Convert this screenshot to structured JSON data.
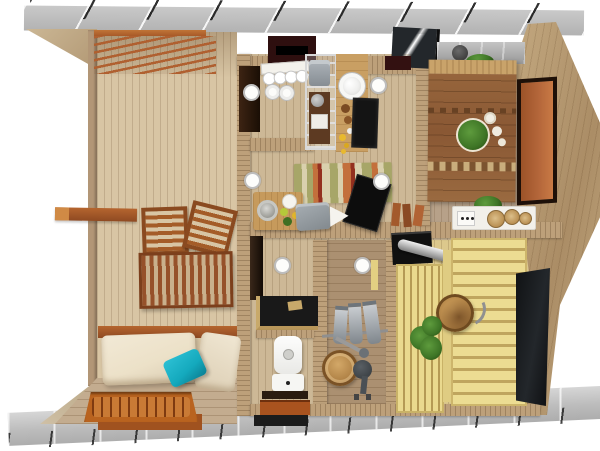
{
  "scene": {
    "description": "3D top-down rendering of a small wooden sauna house floor plan with an open deck, kitchen, bedroom, living strip, bathroom, washroom and sauna, bordered by concrete footing strips",
    "view": "top-down cutaway, no text labels",
    "rooms": [
      {
        "name": "deck-terrace",
        "features": [
          "pergola-slats",
          "lounge-chairs",
          "slatted-table",
          "daybed",
          "teal-pillow",
          "drain-grate",
          "protruding-beam"
        ]
      },
      {
        "name": "kitchen",
        "features": [
          "dish-shelf",
          "metal-rack",
          "sink-counter",
          "induction-cooktop",
          "window",
          "skylight"
        ]
      },
      {
        "name": "bedroom",
        "features": [
          "double-bed",
          "potted-plant",
          "stone-ledge",
          "orange-door"
        ]
      },
      {
        "name": "living-area",
        "features": [
          "striped-rug",
          "tv-panel",
          "food-tray",
          "gray-cushion",
          "ceiling-lights"
        ]
      },
      {
        "name": "bathroom",
        "features": [
          "toilet",
          "shower-counter",
          "floor-mats"
        ]
      },
      {
        "name": "washroom",
        "features": [
          "towel-rail",
          "wooden-barrel",
          "water-pump"
        ]
      },
      {
        "name": "sauna",
        "features": [
          "sauna-stove",
          "chimney-pipe",
          "tiered-benches",
          "wooden-bucket",
          "birch-whisk",
          "glass-door"
        ]
      }
    ],
    "ceiling_light_count": 6
  },
  "palette": {
    "background": "#ffffff",
    "concrete": "#c2c2c2",
    "concrete_dark": "#a9a9a9",
    "deck_floor": "#d8c5a4",
    "interior_floor": "#cdb896",
    "bedroom_floor": "#b7a189",
    "washroom_floor": "#ab9071",
    "sauna_floor": "#dcc88c",
    "wall": "#bda07a",
    "wall_dark": "#a88a64",
    "sienna_wood": "#a4572a",
    "pergola_slat": "#b06030",
    "bed_wood": "#8d5c36",
    "bench_yellow": "#ead98e",
    "bench_gap": "#b59a55",
    "mattress_cream": "#ece1c8",
    "pillow_teal": "#14a9bd",
    "stove_black": "#141414",
    "door_orange": "#b4663a",
    "towel_gray": "#9aa2a8",
    "plant_green": "#3e7526",
    "stone_gray": "#9b9b9b",
    "rug_green": "#a7a668",
    "rug_cream": "#d9d0ad",
    "rug_orange": "#c3703c",
    "rug_red": "#93301f",
    "glass_dark": "#23272b"
  }
}
